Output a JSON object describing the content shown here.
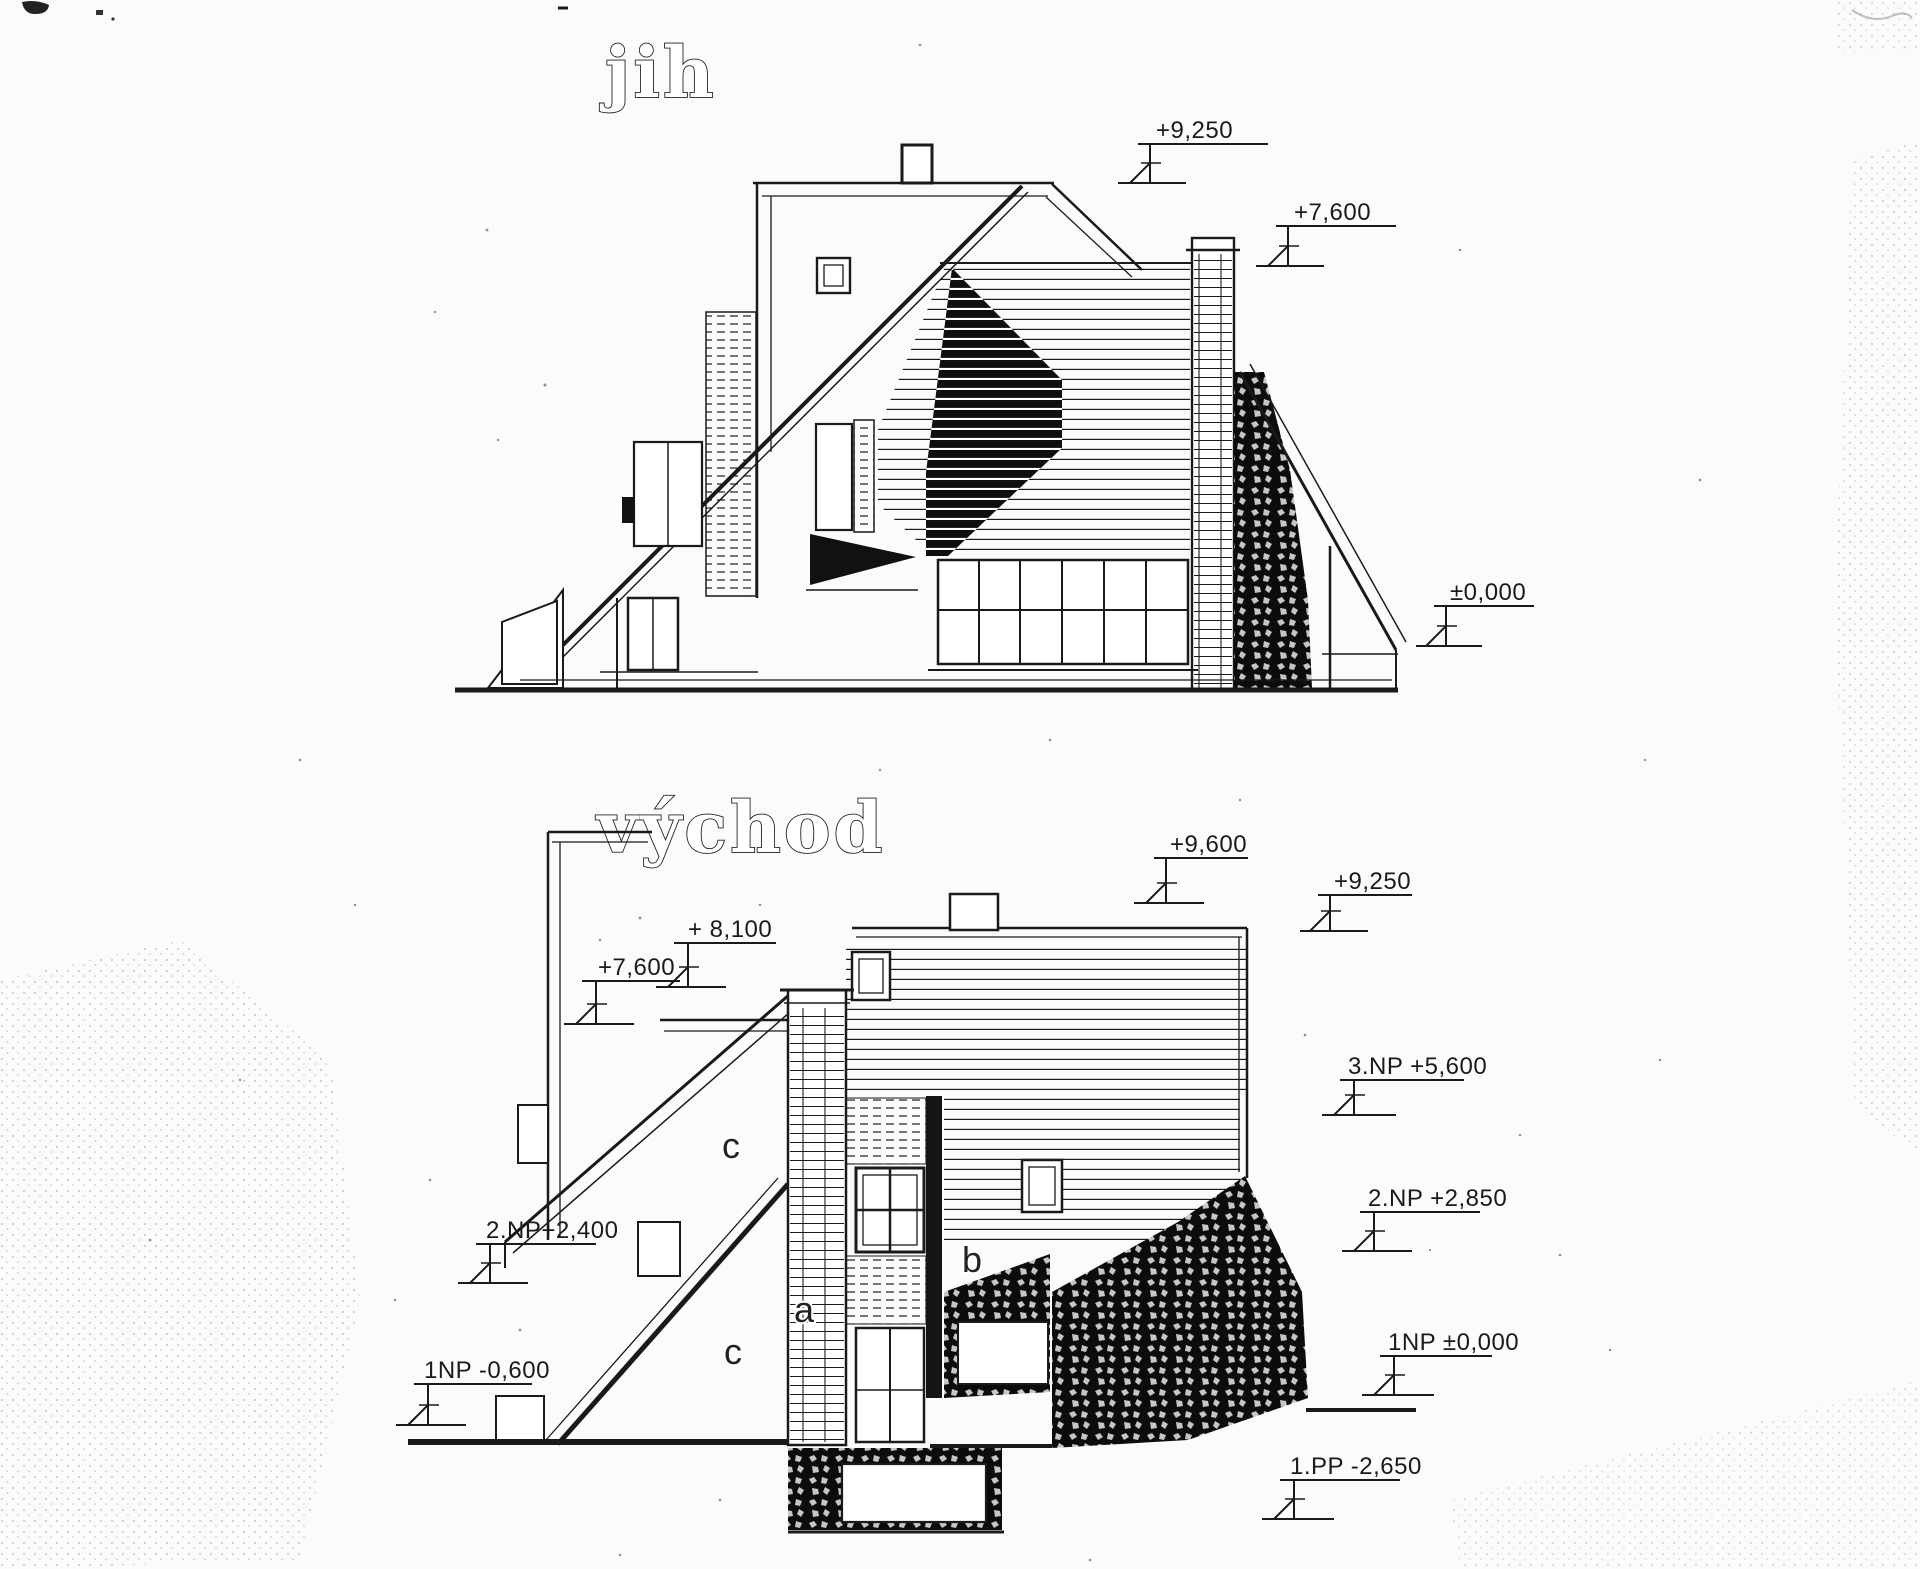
{
  "colors": {
    "ink": "#1a1a1a",
    "paper": "#fcfbf9"
  },
  "drawings": {
    "south": {
      "title": "jih",
      "markers": {
        "p9250": {
          "label": "+9,250"
        },
        "p7600": {
          "label": "+7,600"
        },
        "zero": {
          "label": "±0,000"
        }
      }
    },
    "east": {
      "title": "východ",
      "markers": {
        "p9600": {
          "label": "+9,600"
        },
        "p9250": {
          "label": "+9,250"
        },
        "p8100": {
          "label": "+ 8,100"
        },
        "p7600": {
          "label": "+7,600"
        },
        "np3_5600": {
          "label": "3.NP +5,600"
        },
        "np2_2850": {
          "label": "2.NP +2,850"
        },
        "np2_2400": {
          "label": "2.NP+2,400"
        },
        "np1_m0600": {
          "label": "1NP -0,600"
        },
        "np1_zero": {
          "label": "1NP ±0,000"
        },
        "pp1_m2650": {
          "label": "1.PP -2,650"
        }
      },
      "section_labels": {
        "c_upper": "c",
        "a": "a",
        "b": "b",
        "c_lower": "c"
      }
    }
  }
}
